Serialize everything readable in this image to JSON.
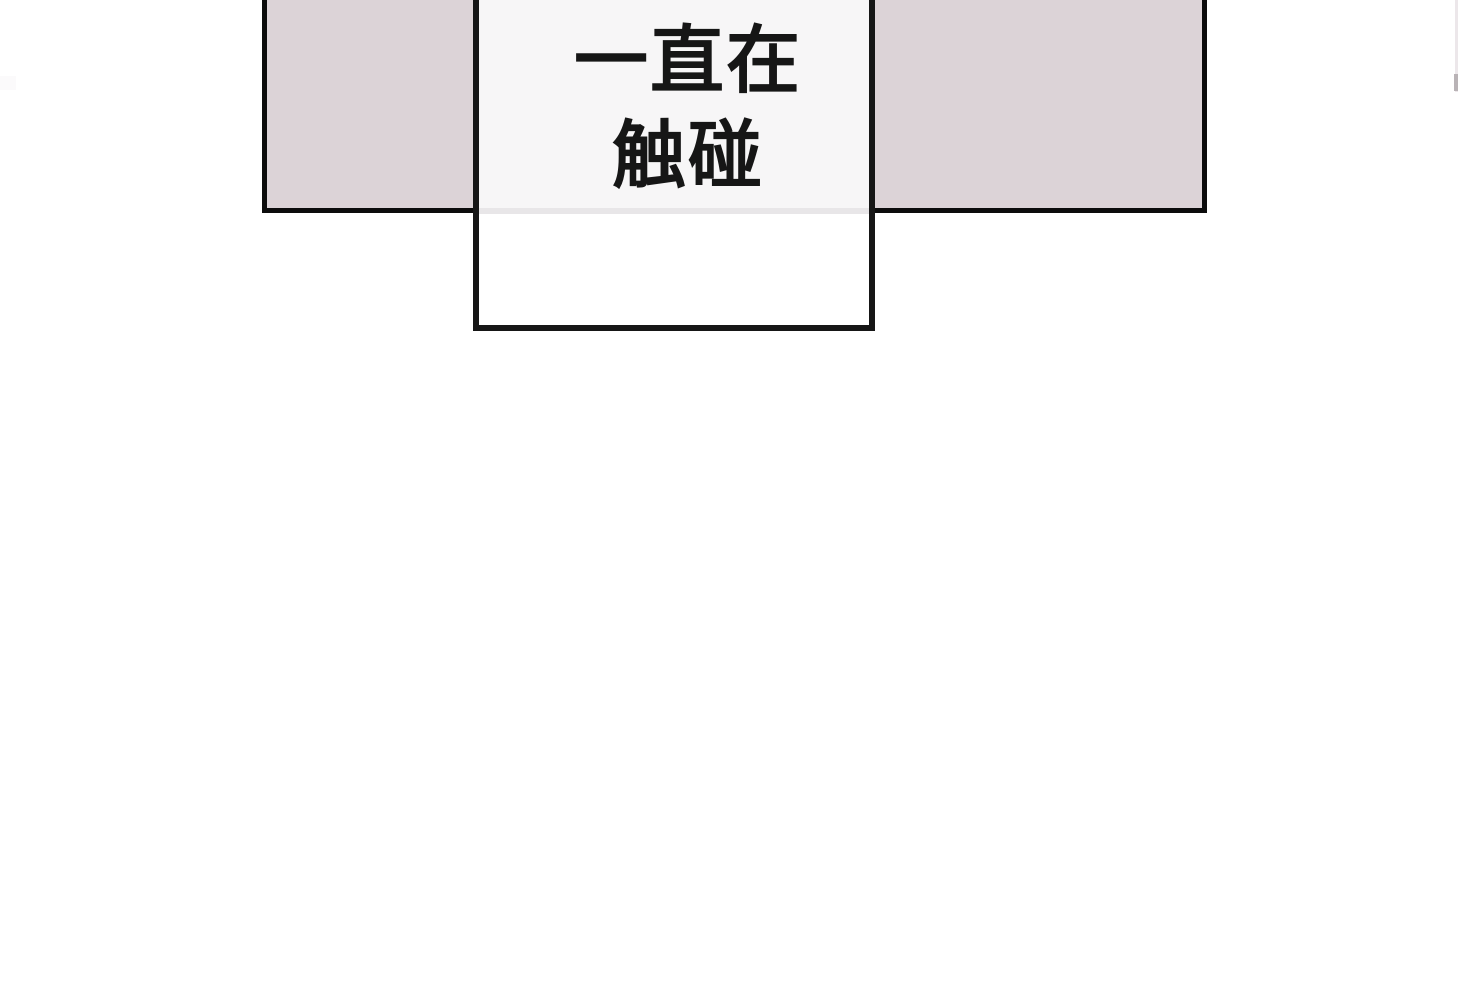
{
  "speech_box": {
    "lines": [
      "一直在",
      "触碰"
    ]
  },
  "colors": {
    "page_bg": "#ffffff",
    "panel_fill": "#dcd3d7",
    "panel_border": "#0c0c0c",
    "box_fill": "#ffffff",
    "box_border": "#161616",
    "box_tint": "#f7f6f7",
    "panel_border_showthrough": "#e8e6e8",
    "text": "#161616",
    "edge_sliver": "#ece7ea",
    "edge_sliver_blob": "#b9b3b6",
    "edge_artifact": "#fbfafb"
  }
}
